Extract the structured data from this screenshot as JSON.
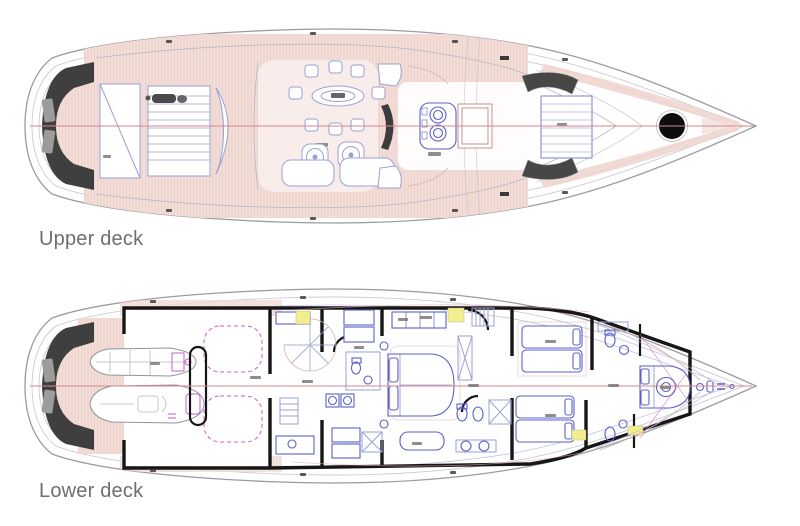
{
  "plans": {
    "upper_deck": {
      "label": "Upper deck"
    },
    "lower_deck": {
      "label": "Lower deck"
    }
  },
  "colors": {
    "background": "#ffffff",
    "teak_deck_pink": "#f4ded8",
    "teak_plank_lines": "#e8cdc6",
    "hull_outline": "#9b9ba3",
    "furniture_line_light": "#9aa0d6",
    "furniture_line_strong": "#5a60c8",
    "magenta_detail": "#c45fc4",
    "red_centerline": "#d6878d",
    "dark_platform": "#3f3f3f",
    "bulkhead_wall": "#161616",
    "highlight_yellow": "#f2ee8d",
    "label_text": "#6e6e6e"
  }
}
